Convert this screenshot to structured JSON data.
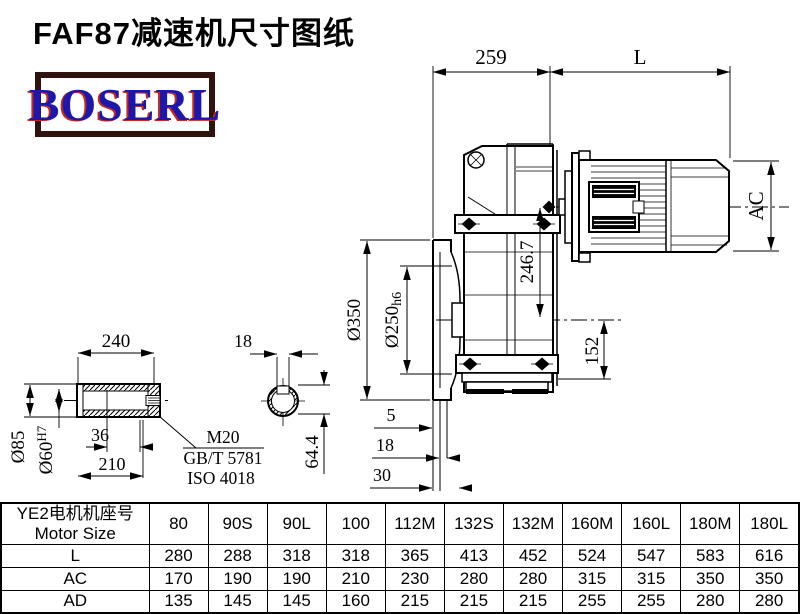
{
  "title": "FAF87减速机尺寸图纸",
  "logo": {
    "text": "BOSERL",
    "text_color": "#1c17ad",
    "shadow_color": "#c6281c",
    "border_color": "#31130e"
  },
  "dims": {
    "total_width": "259",
    "motor_length": "L",
    "motor_diameter": "AC",
    "axis_height": "246.7",
    "flange_od": "Ø350",
    "spigot_base": "Ø250",
    "spigot_tol": "h6",
    "output_bottom": "152",
    "flange_t1": "5",
    "flange_t2": "18",
    "flange_t3": "30",
    "shaft_len": "240",
    "shaft_od": "Ø85",
    "bore_base": "Ø60",
    "bore_tol": "H7",
    "bore_step": "36",
    "bore_depth": "210",
    "keyway_width": "18",
    "keyway_depth": "64.4",
    "thread": "M20",
    "std_gb": "GB/T 5781",
    "std_iso": "ISO 4018"
  },
  "table": {
    "header": {
      "line1": "YE2电机机座号",
      "line2": "Motor Size"
    },
    "columns": [
      "80",
      "90S",
      "90L",
      "100",
      "112M",
      "132S",
      "132M",
      "160M",
      "160L",
      "180M",
      "180L"
    ],
    "rows": [
      {
        "label": "L",
        "values": [
          "280",
          "288",
          "318",
          "318",
          "365",
          "413",
          "452",
          "524",
          "547",
          "583",
          "616"
        ]
      },
      {
        "label": "AC",
        "values": [
          "170",
          "190",
          "190",
          "210",
          "230",
          "280",
          "280",
          "315",
          "315",
          "350",
          "350"
        ]
      },
      {
        "label": "AD",
        "values": [
          "135",
          "145",
          "145",
          "160",
          "215",
          "215",
          "215",
          "255",
          "255",
          "280",
          "280"
        ]
      }
    ]
  }
}
